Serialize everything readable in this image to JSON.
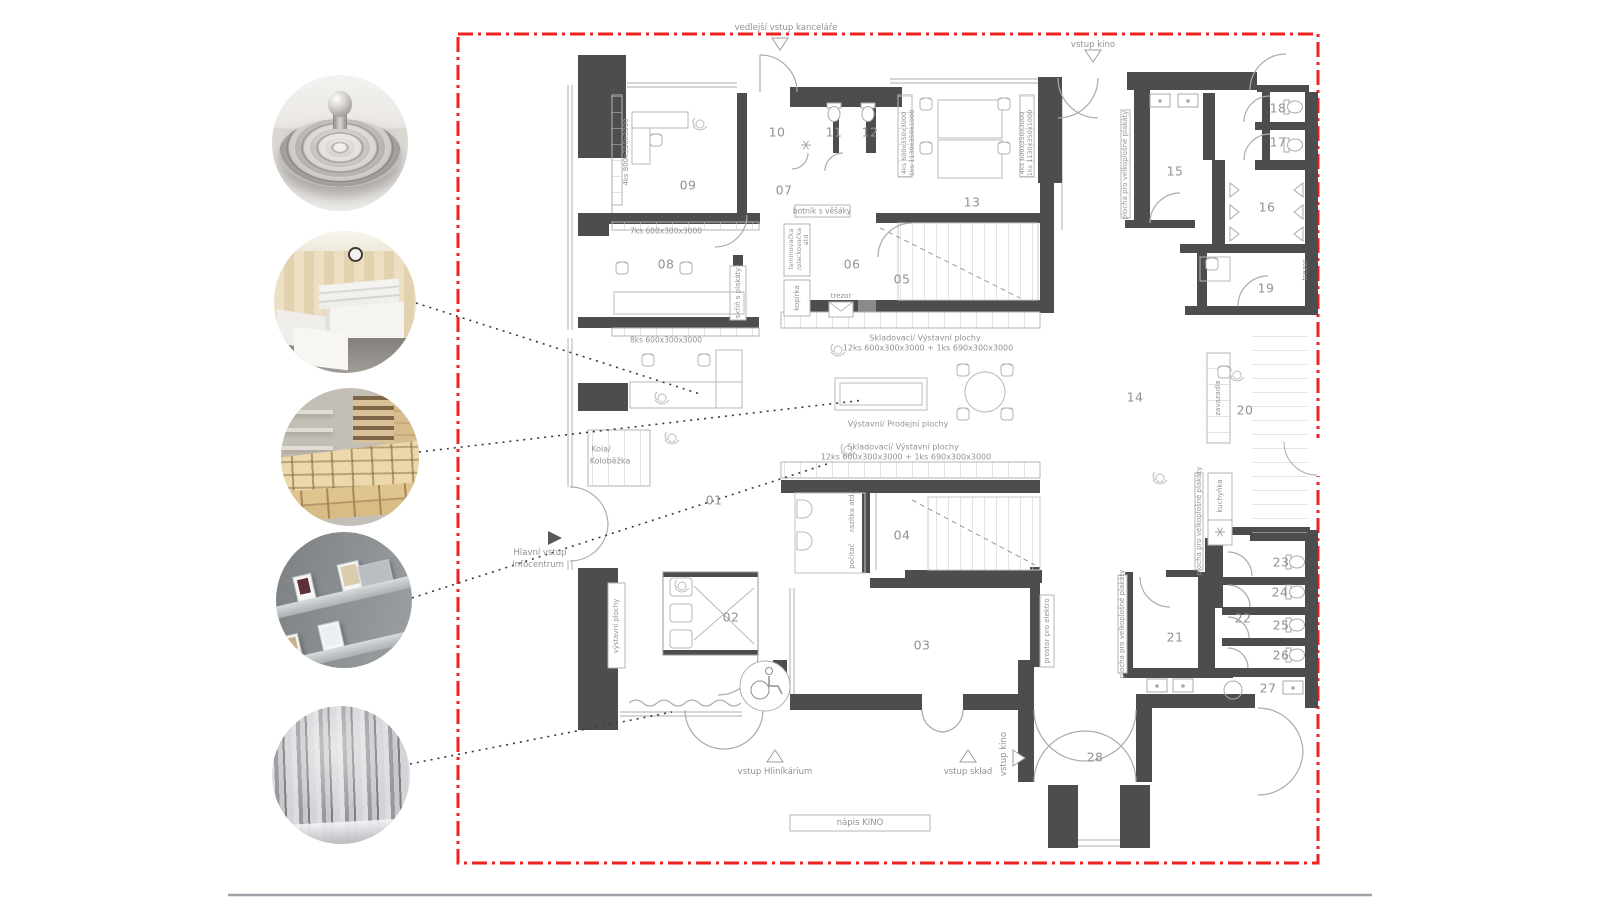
{
  "colors": {
    "accent_red": "#ee2222",
    "wall": "#4d4d4d",
    "thin_line": "#bdbdbd",
    "text": "#8f9396"
  },
  "photos": [
    {
      "name": "metal-lid-photo"
    },
    {
      "name": "reception-desk-photo"
    },
    {
      "name": "wooden-shelving-photo"
    },
    {
      "name": "poster-ledges-photo"
    },
    {
      "name": "foil-curtain-photo"
    }
  ],
  "plan": {
    "rooms": [
      {
        "id": "01",
        "x": 714,
        "y": 500
      },
      {
        "id": "02",
        "x": 731,
        "y": 617
      },
      {
        "id": "03",
        "x": 922,
        "y": 645
      },
      {
        "id": "04",
        "x": 902,
        "y": 535
      },
      {
        "id": "05",
        "x": 902,
        "y": 279
      },
      {
        "id": "06",
        "x": 852,
        "y": 264
      },
      {
        "id": "07",
        "x": 784,
        "y": 190
      },
      {
        "id": "08",
        "x": 666,
        "y": 264
      },
      {
        "id": "09",
        "x": 688,
        "y": 185
      },
      {
        "id": "10",
        "x": 777,
        "y": 132
      },
      {
        "id": "11",
        "x": 834,
        "y": 132
      },
      {
        "id": "12",
        "x": 870,
        "y": 132
      },
      {
        "id": "13",
        "x": 972,
        "y": 202
      },
      {
        "id": "14",
        "x": 1135,
        "y": 397
      },
      {
        "id": "15",
        "x": 1175,
        "y": 171
      },
      {
        "id": "16",
        "x": 1267,
        "y": 207
      },
      {
        "id": "17",
        "x": 1278,
        "y": 142
      },
      {
        "id": "18",
        "x": 1278,
        "y": 108
      },
      {
        "id": "19",
        "x": 1266,
        "y": 288
      },
      {
        "id": "20",
        "x": 1245,
        "y": 410
      },
      {
        "id": "21",
        "x": 1175,
        "y": 637
      },
      {
        "id": "22",
        "x": 1243,
        "y": 618
      },
      {
        "id": "23",
        "x": 1281,
        "y": 562
      },
      {
        "id": "24",
        "x": 1280,
        "y": 592
      },
      {
        "id": "25",
        "x": 1281,
        "y": 625
      },
      {
        "id": "26",
        "x": 1281,
        "y": 655
      },
      {
        "id": "27",
        "x": 1268,
        "y": 688
      },
      {
        "id": "28",
        "x": 1095,
        "y": 757
      }
    ],
    "annotations": [
      {
        "t": "vedlejší vstup kanceláře",
        "x": 786,
        "y": 28,
        "r": 0,
        "s": 8.5
      },
      {
        "t": "vstup kino",
        "x": 1093,
        "y": 45,
        "r": 0,
        "s": 8.5
      },
      {
        "t": "Hlavní vstup",
        "x": 540,
        "y": 553,
        "r": 0,
        "s": 8.5
      },
      {
        "t": "Infocentrum",
        "x": 538,
        "y": 565,
        "r": 0,
        "s": 8.5
      },
      {
        "t": "vstup Hliníkárium",
        "x": 775,
        "y": 772,
        "r": 0,
        "s": 8.5
      },
      {
        "t": "vstup sklad",
        "x": 968,
        "y": 772,
        "r": 0,
        "s": 8.5
      },
      {
        "t": "vstup kino",
        "x": 1004,
        "y": 754,
        "r": -90,
        "s": 8.5
      },
      {
        "t": "nápis KINO",
        "x": 860,
        "y": 823,
        "r": 0,
        "s": 8.5
      },
      {
        "t": "4ks 800x350x3000",
        "x": 626,
        "y": 152,
        "r": -90,
        "s": 7
      },
      {
        "t": "7ks 600x300x3000",
        "x": 666,
        "y": 231,
        "r": 0,
        "s": 7.5
      },
      {
        "t": "8ks 600x300x3000",
        "x": 666,
        "y": 340,
        "r": 0,
        "s": 7.5
      },
      {
        "t": "skříň s plakáty",
        "x": 738,
        "y": 293,
        "r": -90,
        "s": 7
      },
      {
        "t": "botník s věšáky",
        "x": 822,
        "y": 211,
        "r": 0,
        "s": 7.5
      },
      {
        "t": "laminovačka",
        "x": 791,
        "y": 249,
        "r": -90,
        "s": 6.5
      },
      {
        "t": "/plackovačka",
        "x": 799,
        "y": 249,
        "r": -90,
        "s": 6.5
      },
      {
        "t": "atd",
        "x": 806,
        "y": 240,
        "r": -90,
        "s": 6.5
      },
      {
        "t": "kopírka",
        "x": 797,
        "y": 298,
        "r": -90,
        "s": 7
      },
      {
        "t": "trezor",
        "x": 841,
        "y": 296,
        "r": 0,
        "s": 7
      },
      {
        "t": "Skladovací/ Výstavní plochy",
        "x": 925,
        "y": 338,
        "r": 0,
        "s": 8
      },
      {
        "t": "12ks 600x300x3000 + 1ks 690x300x3000",
        "x": 928,
        "y": 348,
        "r": 0,
        "s": 8
      },
      {
        "t": "Výstavní/ Prodejní plochy",
        "x": 898,
        "y": 424,
        "r": 0,
        "s": 8
      },
      {
        "t": "Skladovací/ Výstavní plochy",
        "x": 903,
        "y": 447,
        "r": 0,
        "s": 8
      },
      {
        "t": "12ks 600x300x3000 + 1ks 690x300x3000",
        "x": 906,
        "y": 457,
        "r": 0,
        "s": 8
      },
      {
        "t": "Kola/",
        "x": 601,
        "y": 449,
        "r": 0,
        "s": 8
      },
      {
        "t": "Koloběžka",
        "x": 610,
        "y": 461,
        "r": 0,
        "s": 8
      },
      {
        "t": "razítka atd.",
        "x": 852,
        "y": 512,
        "r": -90,
        "s": 7
      },
      {
        "t": "počítač",
        "x": 852,
        "y": 556,
        "r": -90,
        "s": 7
      },
      {
        "t": "výstavní plochy",
        "x": 616,
        "y": 626,
        "r": -90,
        "s": 7
      },
      {
        "t": "prostor pro elektro",
        "x": 1047,
        "y": 631,
        "r": -90,
        "s": 7
      },
      {
        "t": "4ks 600x350x3000",
        "x": 904,
        "y": 143,
        "r": -90,
        "s": 6.5
      },
      {
        "t": "1ks 1130x350x1000",
        "x": 912,
        "y": 143,
        "r": -90,
        "s": 6.5
      },
      {
        "t": "4ks 600x350x3000",
        "x": 1022,
        "y": 143,
        "r": -90,
        "s": 6.5
      },
      {
        "t": "1ks 1130x350x1000",
        "x": 1030,
        "y": 143,
        "r": -90,
        "s": 6.5
      },
      {
        "t": "plocha pro velkoplošné plakáty",
        "x": 1125,
        "y": 165,
        "r": -90,
        "s": 7
      },
      {
        "t": "plocha pro velkoplošné plakáty",
        "x": 1122,
        "y": 624,
        "r": -90,
        "s": 7
      },
      {
        "t": "plocha pro velkoplošné plakáty",
        "x": 1199,
        "y": 521,
        "r": -90,
        "s": 7
      },
      {
        "t": "kuchyňka",
        "x": 1220,
        "y": 496,
        "r": -90,
        "s": 7
      },
      {
        "t": "zavazadla",
        "x": 1218,
        "y": 398,
        "r": -90,
        "s": 7
      },
      {
        "t": "trezor",
        "x": 1305,
        "y": 270,
        "r": -90,
        "s": 7
      }
    ]
  }
}
